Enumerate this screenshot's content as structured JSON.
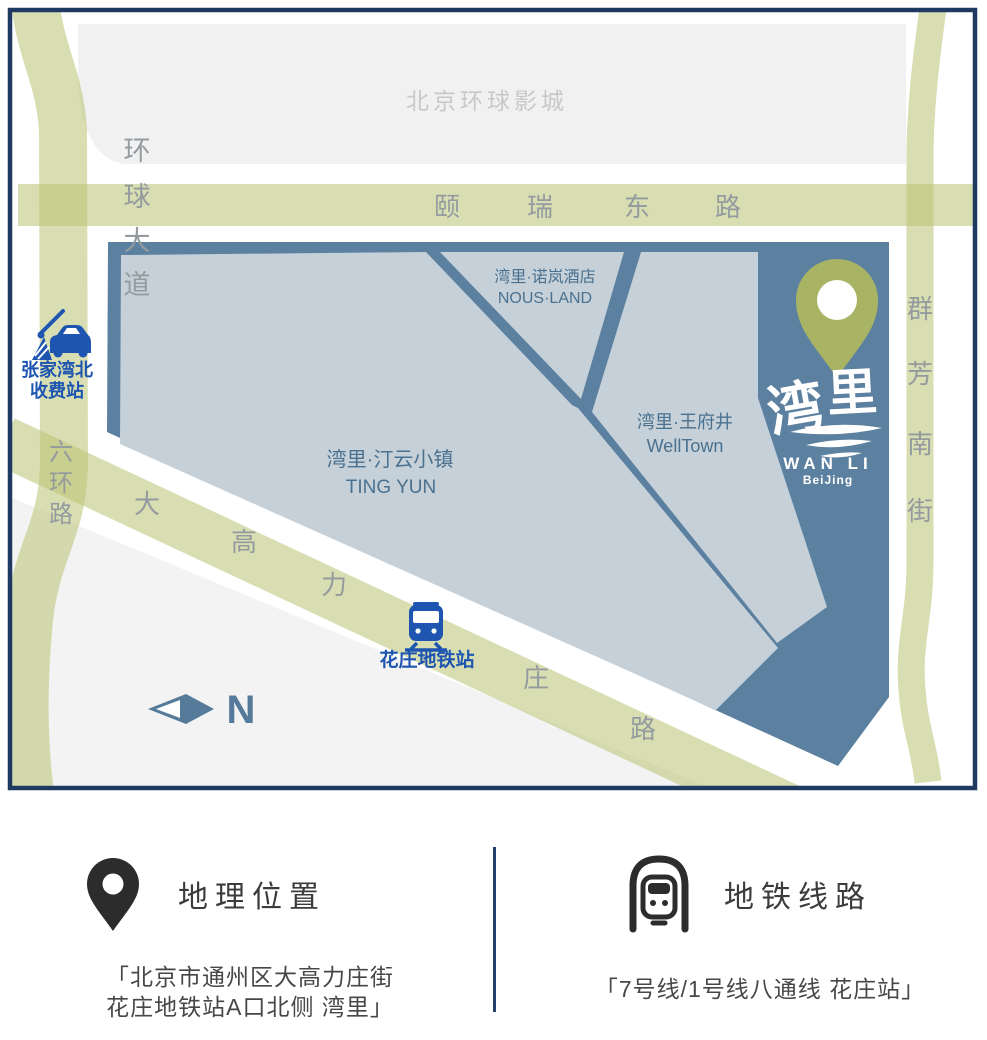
{
  "map": {
    "universal_area": "北京环球影城",
    "roads": {
      "huanqiu": [
        "环",
        "球",
        "大",
        "道"
      ],
      "yirui": [
        "颐",
        "瑞",
        "东",
        "路"
      ],
      "liuhuan": [
        "六",
        "环",
        "路"
      ],
      "dagaoli": [
        "大",
        "高",
        "力",
        "庄",
        "路"
      ],
      "qunfang": [
        "群",
        "芳",
        "南",
        "街"
      ]
    },
    "areas": {
      "tingyun_cn": "湾里·汀云小镇",
      "tingyun_en": "TING YUN",
      "nous_cn": "湾里·诺岚酒店",
      "nous_en": "NOUS·LAND",
      "welltown_cn": "湾里·王府井",
      "welltown_en": "WellTown"
    },
    "toll_line1": "张家湾北",
    "toll_line2": "收费站",
    "metro_label": "花庄地铁站",
    "compass": "N",
    "logo": {
      "cn": "湾里",
      "en": "WAN LI",
      "sub": "BeiJing"
    }
  },
  "info": {
    "location": {
      "title": "地理位置",
      "line1": "「北京市通州区大高力庄街",
      "line2": "花庄地铁站A口北侧 湾里」"
    },
    "metro": {
      "title": "地铁线路",
      "line": "「7号线/1号线八通线 花庄站」"
    }
  },
  "colors": {
    "navy_border": "#1f3a60",
    "road_green": "#dde1b4",
    "parcel_dark": "#5b80a0",
    "parcel_light": "#c5d0d8",
    "pin_olive": "#a9b364",
    "accent_blue": "#1d55b0",
    "gray_area": "#f1f1f2"
  }
}
